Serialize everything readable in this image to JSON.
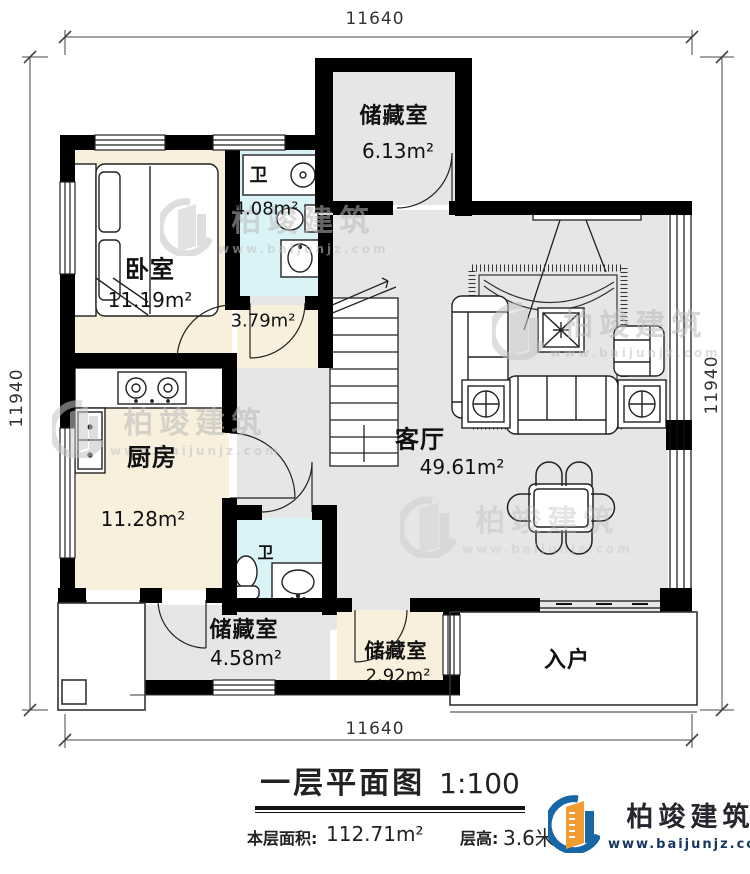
{
  "meta": {
    "type": "architectural-floor-plan",
    "sheet": "first-floor"
  },
  "dimensions": {
    "top": "11640",
    "bottom": "11640",
    "left": "11940",
    "right": "11940"
  },
  "rooms": {
    "storage_top": {
      "name": "储藏室",
      "area": "6.13m²"
    },
    "bedroom": {
      "name": "卧室",
      "area": "11.19m²"
    },
    "bath1": {
      "name": "卫",
      "area": "4.08m²"
    },
    "hall": {
      "area": "3.79m²"
    },
    "kitchen": {
      "name": "厨房",
      "area": "11.28m²"
    },
    "living": {
      "name": "客厅",
      "area": "49.61m²"
    },
    "bath2": {
      "name": "卫"
    },
    "storage_left": {
      "name": "储藏室",
      "area": "4.58m²"
    },
    "storage_right": {
      "name": "储藏室",
      "area": "2.92m²"
    },
    "entry": {
      "name": "入户"
    }
  },
  "title": {
    "text": "一层平面图",
    "scale": "1:100"
  },
  "footer": {
    "area_label": "本层面积:",
    "area_value": "112.71m²",
    "height_label": "层高:",
    "height_value": "3.6米"
  },
  "logo": {
    "name": "柏竣建筑",
    "url": "www.baijunjz.com"
  },
  "watermark": {
    "name": "柏竣建筑",
    "url": "www.baijunjz.com"
  },
  "colors": {
    "wall": "#000000",
    "floor_warm": "#f8efdc",
    "floor_bath": "#daf3f6",
    "floor_gray": "#e6e6e6",
    "logo_blue": "#1766a6",
    "logo_orange": "#f09c30",
    "watermark_gray": "#bfbfbf"
  }
}
